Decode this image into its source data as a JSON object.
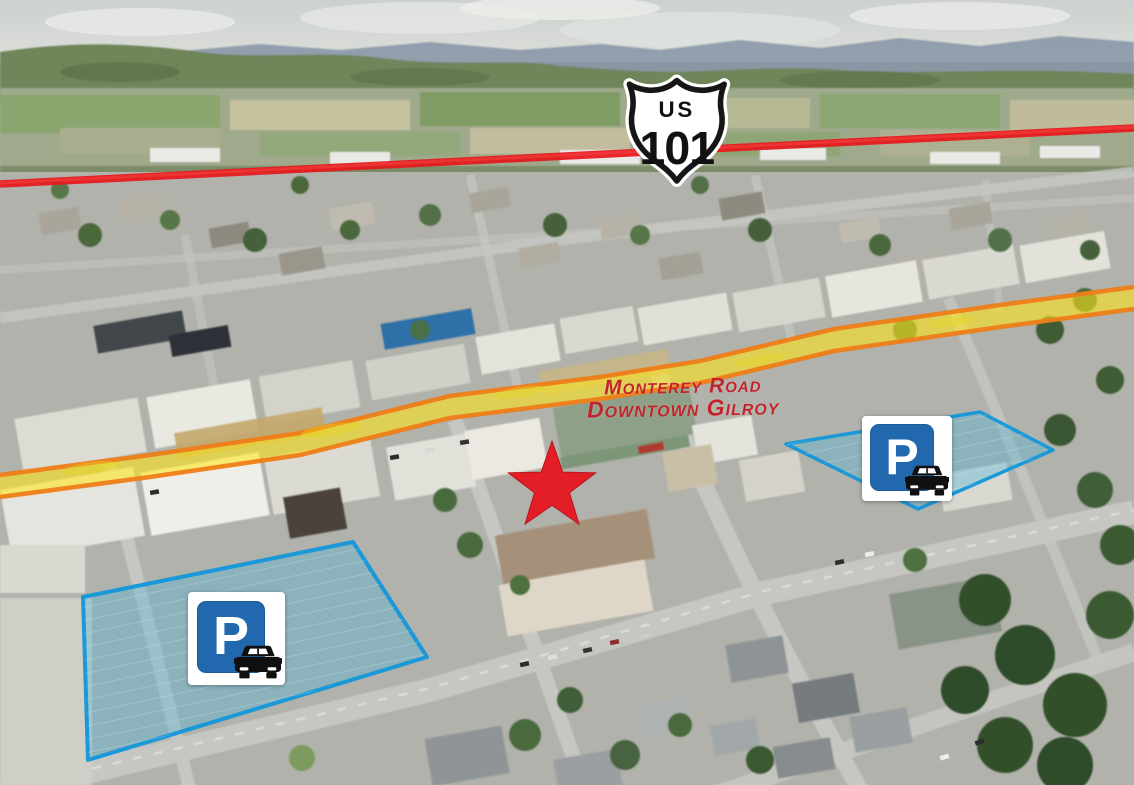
{
  "annotations": {
    "highway_shield": {
      "banner": "US",
      "route_number": "101"
    },
    "road_label": {
      "line1": "Monterey Road",
      "line2": "Downtown Gilroy"
    },
    "parking_sign_letter": "P"
  },
  "colors": {
    "highway_line_red": "#e6181c",
    "road_highlight_yellow": "#ffe616",
    "road_highlight_orange_edge": "#ee7d18",
    "road_label_red": "#c3242b",
    "star_red": "#e41e26",
    "parking_area_fill_blue": "#4ab5dc",
    "parking_area_stroke_blue": "#1b98d8",
    "parking_sign_blue": "#2268ae"
  }
}
